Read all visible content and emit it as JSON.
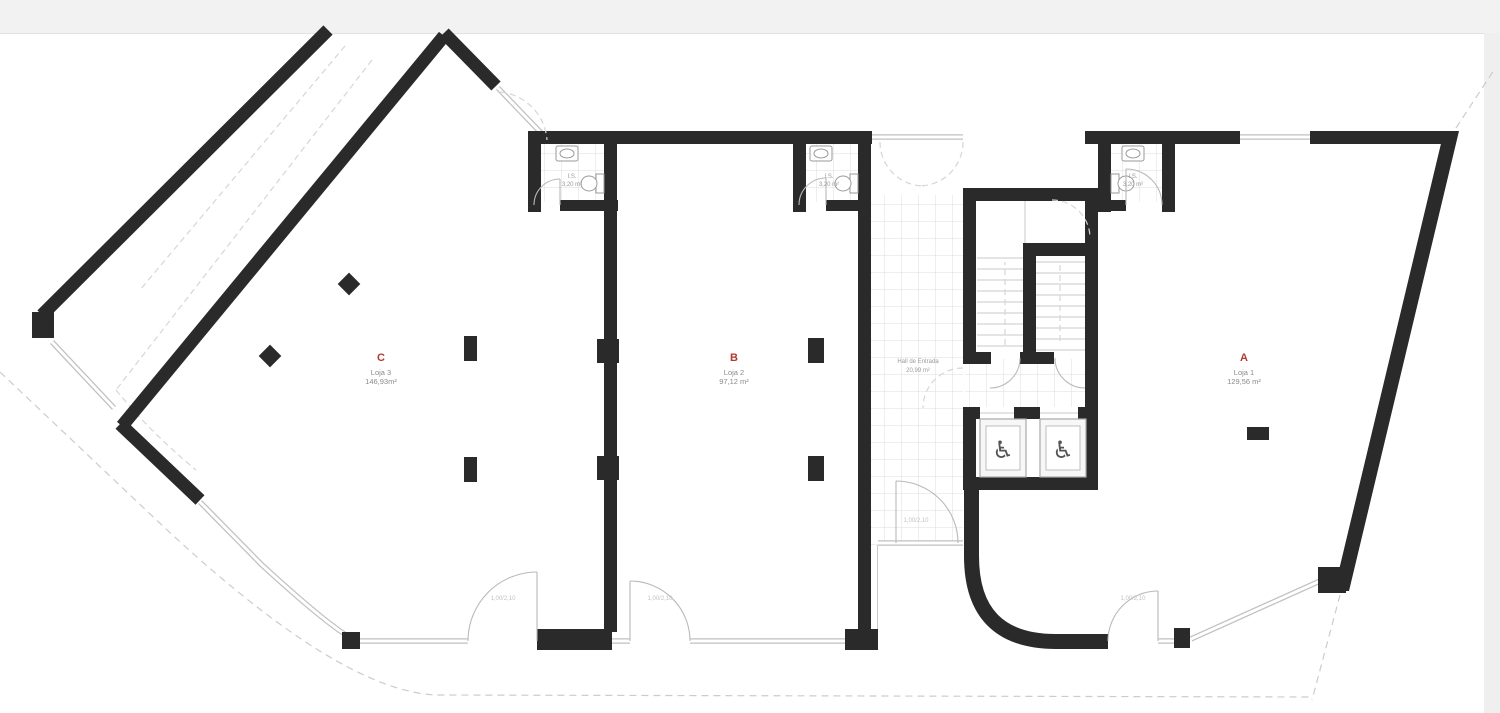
{
  "plan": {
    "colors": {
      "wall": "#2a2a2a",
      "accent": "#b03a2e",
      "tile_line": "#dcdcdc",
      "glass": "#c0c0c0"
    },
    "units": [
      {
        "letter": "A",
        "name": "Loja 1",
        "area": "129,56 m²"
      },
      {
        "letter": "B",
        "name": "Loja 2",
        "area": "97,12 m²"
      },
      {
        "letter": "C",
        "name": "Loja 3",
        "area": "146,93m²"
      }
    ],
    "hall": {
      "name": "Hall de Entrada",
      "area": "20,99 m²"
    },
    "bathrooms": [
      {
        "label": "I.S.",
        "area": "3,20 m²"
      },
      {
        "label": "I.S.",
        "area": "3,20 m²"
      },
      {
        "label": "I.S.",
        "area": "3,20 m²"
      }
    ],
    "doors": [
      {
        "label": "1,00/2,10"
      },
      {
        "label": "1,00/2,10"
      },
      {
        "label": "1,00/2,10"
      },
      {
        "label": "1,00/2,10"
      }
    ],
    "icons": {
      "wheelchair": "♿"
    }
  }
}
